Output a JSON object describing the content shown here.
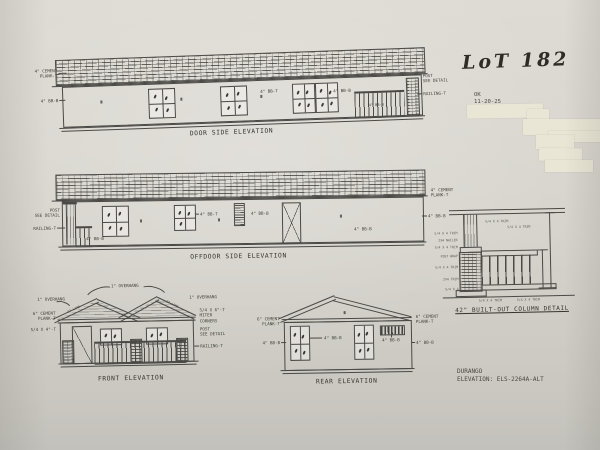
{
  "note": {
    "lot": "LoT 182",
    "ok": "OK",
    "date": "11-20-25"
  },
  "door_side": {
    "caption": "DOOR SIDE ELEVATION",
    "labels": {
      "cement_plank": "4\" CEMENT\nPLANK-T",
      "bb_left": "4\" BB-B",
      "bb_mid": "4\" BB-T",
      "bb_mid2": "4\" BB-B",
      "bb_porch": "4\" BB-B",
      "post": "POST\nSEE DETAIL",
      "railing": "RAILING-T"
    }
  },
  "offdoor_side": {
    "caption": "OFFDOOR SIDE ELEVATION",
    "labels": {
      "post": "POST\nSEE DETAIL",
      "railing": "RAILING-T",
      "bb_b1": "4\" BB-B",
      "bb_t": "4\" BB-T",
      "bb_b2": "4\" BB-B",
      "bb_b3": "4\" BB-B",
      "cement_plank": "4\" CEMENT\nPLANK-T",
      "bb_b4": "4\" BB-B"
    }
  },
  "front": {
    "caption": "FRONT ELEVATION",
    "labels": {
      "overhang_top": "1\" OVERHANG",
      "overhang_left": "1\" OVERHANG",
      "overhang_right": "1\" OVERHANG",
      "cement_plank": "6\" CEMENT\nPLANK-T",
      "trim": "5/4 X 4\"-T",
      "miter": "5/4 X 6\"-T\nMITER\nCORNERS",
      "post": "POST\nSEE DETAIL",
      "railing": "RAILING-T",
      "roof_note_left": "ET LINE",
      "roof_note_right": "ET LINE"
    }
  },
  "rear": {
    "caption": "REAR ELEVATION",
    "labels": {
      "cement_left": "6\" CEMENT\nPLANK-T",
      "cement_right": "6\" CEMENT\nPLANK-T",
      "bb_left": "4\" BB-B",
      "bb_center": "4\" BB-B",
      "bb_vent": "4\" BB-B",
      "bb_right": "4\" BB-B"
    }
  },
  "column_detail": {
    "caption": "42\" BUILT-OUT COLUMN DETAIL",
    "callouts": [
      "5/4 X 4 TRIM",
      "2X4 NAILER",
      "5/4 X 4 TRIM",
      "POST WRAP",
      "5/4 X 4 TRIM",
      "2X4 TRIM",
      "5/4 X 4",
      "5/4 X 4 TRIM",
      "5/4 X 4 TRIM",
      "5/4 X 4 TRIM",
      "5/4 X 4 TRIM"
    ]
  },
  "titleblock": {
    "model": "DURANGO",
    "elevation": "ELEVATION: ELS-2264A-ALT"
  }
}
